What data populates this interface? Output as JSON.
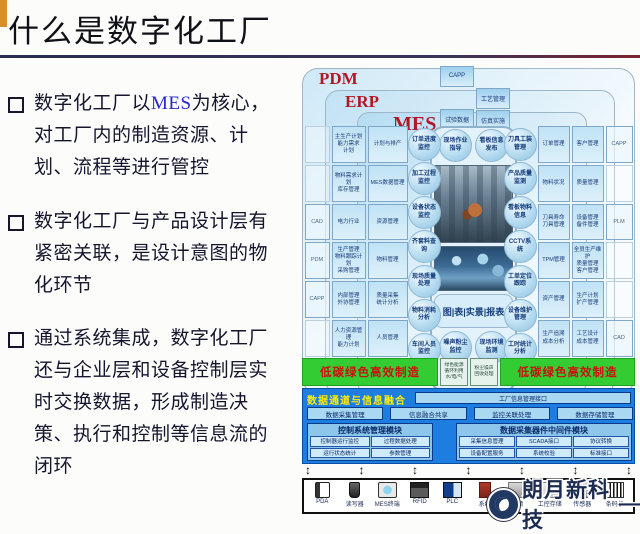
{
  "colors": {
    "accent_orange": "#d98e2b",
    "green_bar": "#33cc33",
    "green_bar_text": "#cc1111",
    "panel_blue": "#1e7de0",
    "ring_blue": "#cfe9f7",
    "ring_label_red": "#b01826",
    "mes_text_blue": "#2626cc"
  },
  "slide": {
    "title": "什么是数字化工厂"
  },
  "bullets": [
    {
      "pre": "数字化工厂以",
      "mes": "MES",
      "post": "为核心，对工厂内的制造资源、计划、流程等进行管控"
    },
    {
      "text": "数字化工厂与产品设计层有紧密关联，是设计意图的物化环节"
    },
    {
      "text": "通过系统集成，数字化工厂还与企业层和设备控制层实时交换数据，形成制造决策、执行和控制等信息流的闭环"
    }
  ],
  "diagram": {
    "rings": {
      "pdm": "PDM",
      "erp": "ERP",
      "mes": "MES"
    },
    "arrow_glyph": "↕",
    "top_col_a": [
      "CAPP",
      "试验数据"
    ],
    "top_col_b": [
      "工艺管理",
      "仿真实施"
    ],
    "left_outer": [
      "",
      "",
      "CAD",
      "PDM",
      "CAPP",
      ""
    ],
    "left_erp": [
      "主生产计划\n能力需求\n计划",
      "物料需求计划\n库存管理",
      "电力行业",
      "生产管理\n物料跟踪计划\n采购管理",
      "内部管理\n外协管理",
      "人力资源管理\n能力计划"
    ],
    "left_mes": [
      "计划与排产",
      "MES数据管理",
      "资源管理",
      "物料管理",
      "质量采集\n统计分析",
      "人员管理"
    ],
    "right_mes": [
      "订单管理",
      "物料状况",
      "刀具寿命\n刀具管理",
      "TPM管理",
      "资产管理",
      "生产追溯\n成本分析"
    ],
    "right_erp": [
      "客户管理",
      "质量管理",
      "设备管理\n备件管理",
      "全员生产维护\n质量管理\n客户管理",
      "生产计划\n扩产管理",
      "工艺设计\n成本管理"
    ],
    "right_outer": [
      "CAPP",
      "",
      "PLM",
      "",
      "",
      "CAD"
    ],
    "bubbles_left": [
      "订单进度监控",
      "加工过程监控",
      "设备状态监控",
      "齐套料查询",
      "现场质量处理",
      "物料消耗分析",
      "车间人员监控"
    ],
    "bubbles_top": [
      "现场作业指导",
      "看板信息发布"
    ],
    "bubbles_bottom": [
      "噪声粉尘监控",
      "现场环境监测"
    ],
    "bubbles_right": [
      "刀具工装管理",
      "产品质量监测",
      "看板物料信息",
      "CCTV系统",
      "工单定位跟踪",
      "设备维护管理",
      "工时统计分析"
    ],
    "center_caption": "图|表|实景|报表",
    "green_bar_left": "低碳绿色高效制造",
    "green_bar_right": "低碳绿色高效制造",
    "green_mid_boxes": [
      "绿色能源\n循环利用\n水/电/气",
      "粉尘噪声\n回收处理"
    ],
    "panel": {
      "header_label": "数据通道与信息融合",
      "header_box": "工厂信息管理接口",
      "channels": [
        "数据采集管理",
        "信息融合共享",
        "监控关联处理",
        "数据存储管理"
      ],
      "module1": {
        "title": "控制系统管理模块",
        "cells": [
          "控制器运行监控",
          "过程数据处理",
          "运行状态统计",
          "参数管理"
        ]
      },
      "module2": {
        "title": "数据采集器件中间件模块",
        "cells": [
          "采集信息管理",
          "SCADA接口",
          "协议转换",
          "设备配置服务",
          "系统校验",
          "标准接口"
        ]
      }
    },
    "devices": [
      {
        "icon": "pda-icon",
        "label": "PDA"
      },
      {
        "icon": "card-reader-icon",
        "label": "读写器"
      },
      {
        "icon": "mes-terminal-icon",
        "label": "MES终端"
      },
      {
        "icon": "rfid-icon",
        "label": "RFID"
      },
      {
        "icon": "plc-icon",
        "label": "PLC"
      },
      {
        "icon": "system-icon",
        "label": "系统"
      },
      {
        "icon": "camera-icon",
        "label": "视频"
      },
      {
        "icon": "ipc-icon",
        "label": "工控存储"
      },
      {
        "icon": "sensor-icon",
        "label": "传感器"
      },
      {
        "icon": "barcode-icon",
        "label": "条码机"
      }
    ]
  },
  "watermark": {
    "text": "朗月新科技",
    "dash": "—"
  }
}
